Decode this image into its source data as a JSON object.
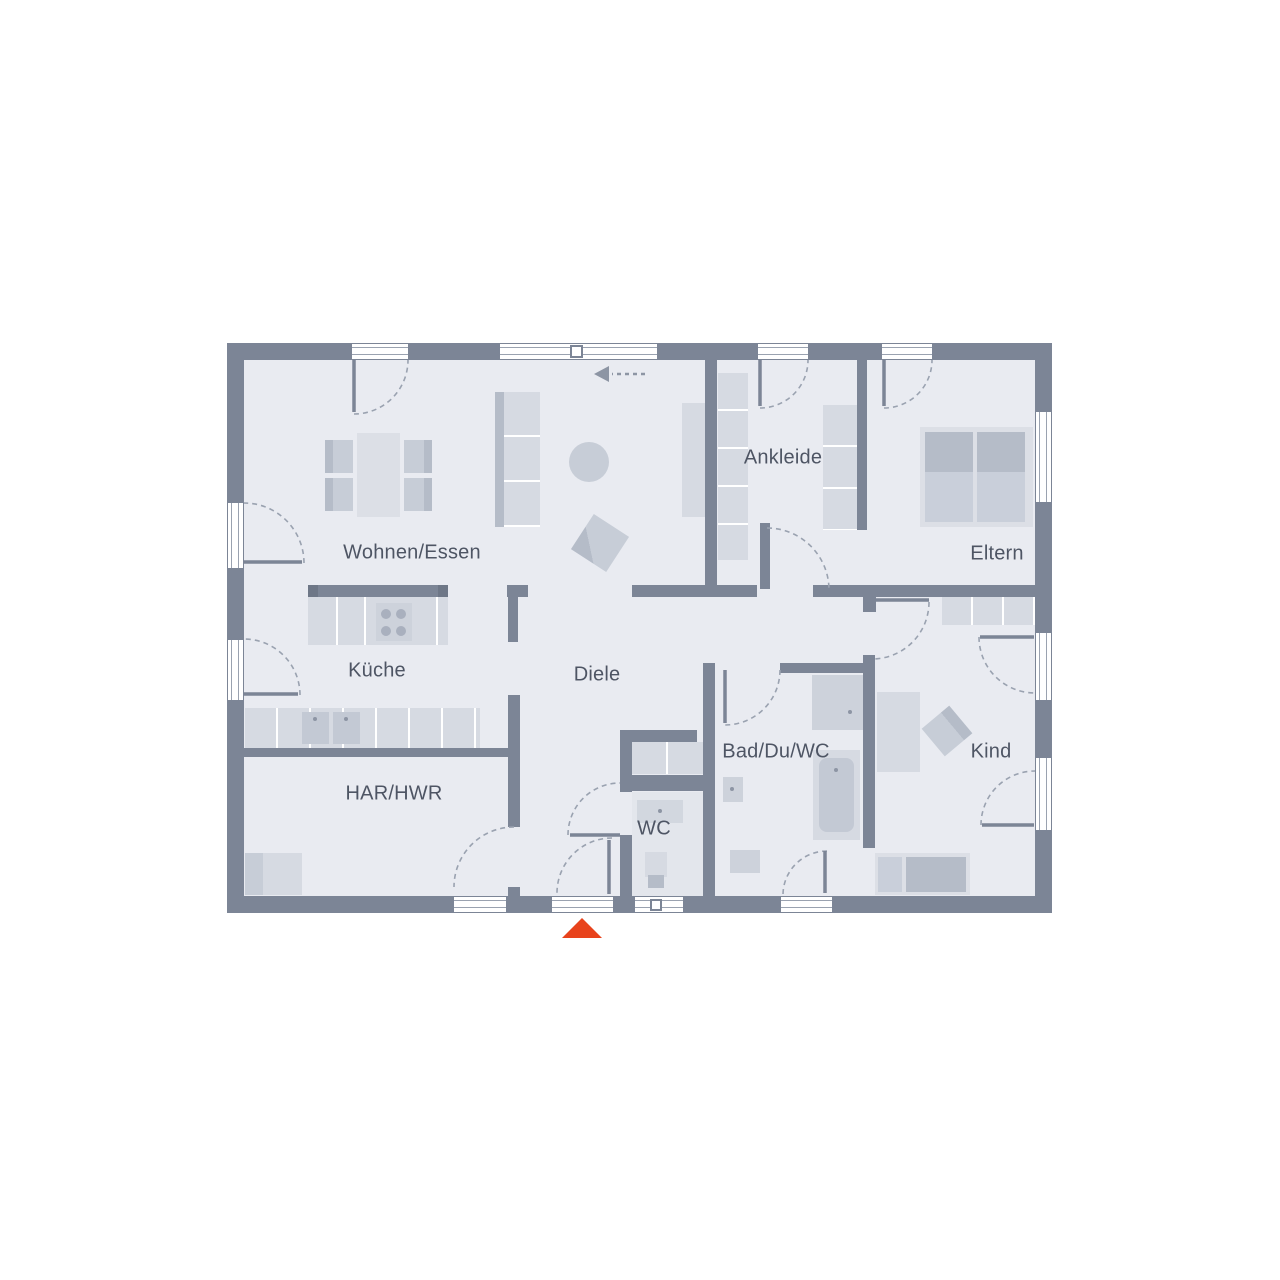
{
  "page": {
    "background": "#ffffff"
  },
  "floorplan": {
    "type": "ground-floor-plan",
    "rooms": [
      {
        "id": "wohnen-essen",
        "name": "Wohnen/Essen"
      },
      {
        "id": "kueche",
        "name": "Küche"
      },
      {
        "id": "diele",
        "name": "Diele"
      },
      {
        "id": "ankleide",
        "name": "Ankleide"
      },
      {
        "id": "eltern",
        "name": "Eltern"
      },
      {
        "id": "har-hwr",
        "name": "HAR/HWR"
      },
      {
        "id": "wc",
        "name": "WC"
      },
      {
        "id": "bad-du-wc",
        "name": "Bad/Du/WC"
      },
      {
        "id": "kind",
        "name": "Kind"
      }
    ],
    "entrance_marker": {
      "shape": "triangle-up",
      "color": "#E8431C"
    },
    "north_arrow": {
      "direction": "left",
      "style": "dashed"
    },
    "colors": {
      "wall": "#7C8596",
      "wall_dark": "#6E7787",
      "floor": "#E9EBF1",
      "furniture_light": "#DCDFE6",
      "furniture": "#D6DAE2",
      "furniture_mid": "#C7CDD7",
      "furniture_dark": "#B5BCC8",
      "line": "#9AA2B0",
      "text": "#4E5564"
    }
  }
}
